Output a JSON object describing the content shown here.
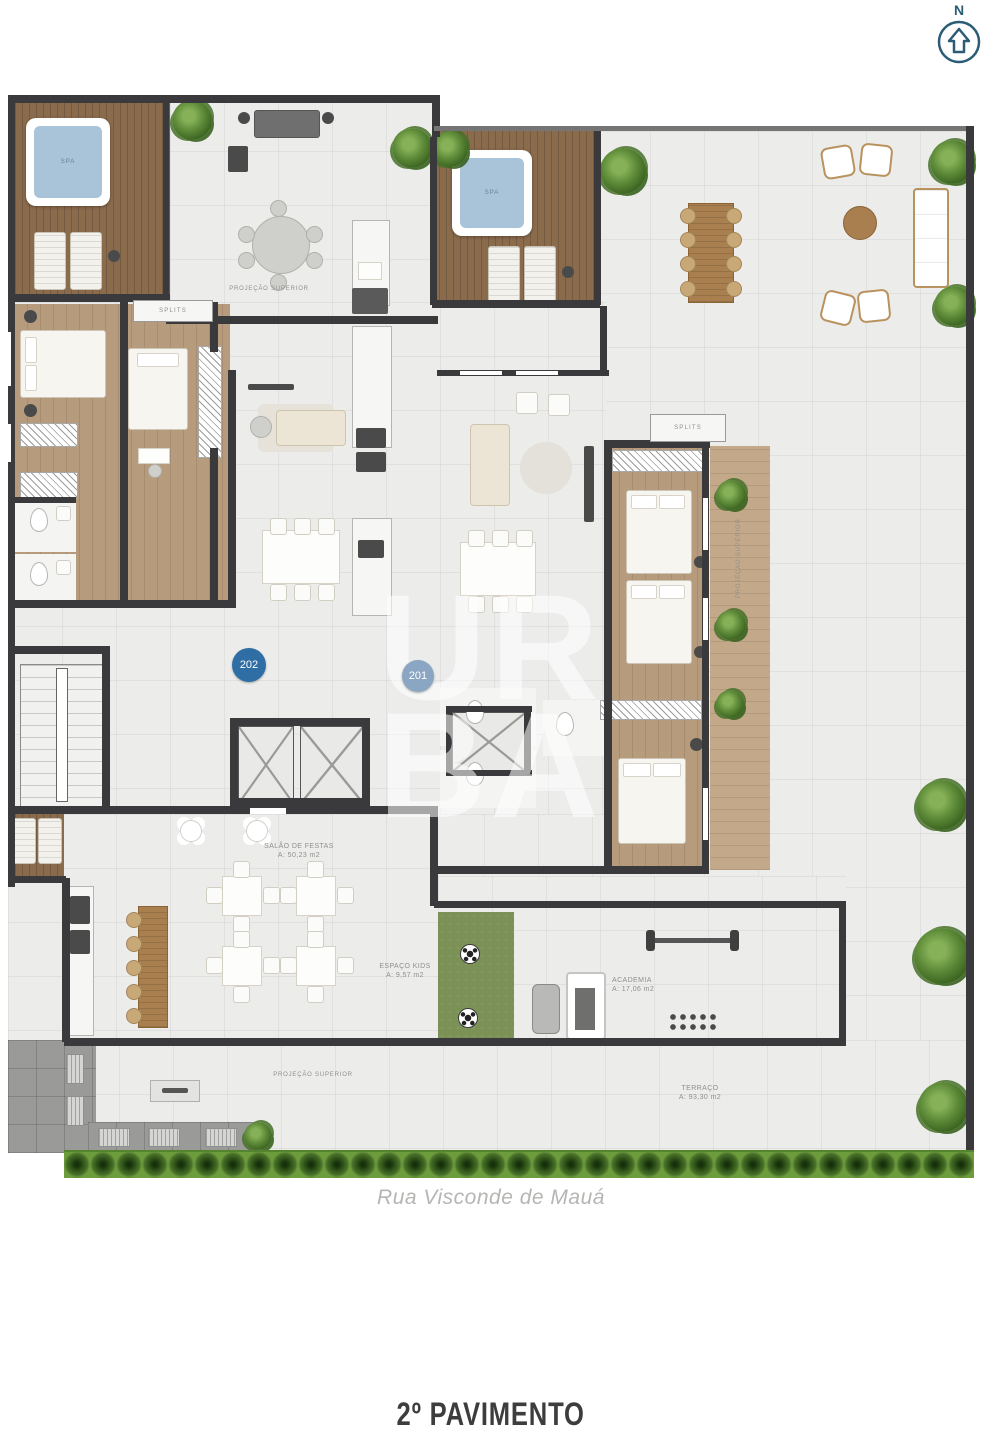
{
  "compass": {
    "letter": "N"
  },
  "plan": {
    "floor_title": "2º PAVIMENTO",
    "street_name": "Rua Visconde de Mauá",
    "watermark_line1": "UR",
    "watermark_line2": "BA",
    "unit_badges": [
      {
        "number": "202"
      },
      {
        "number": "201"
      }
    ],
    "rooms": {
      "spa_left": "SPA",
      "spa_right": "SPA",
      "splits_left": "SPLITS",
      "splits_right": "SPLITS",
      "projecao_top": "PROJEÇÃO SUPERIOR",
      "projecao_right": "PROJEÇÃO SUPERIOR",
      "projecao_bottom": "PROJEÇÃO SUPERIOR",
      "salao_name": "SALÃO DE FESTAS",
      "salao_area": "A: 50,23 m2",
      "kids_name": "ESPAÇO KIDS",
      "kids_area": "A: 9,57 m2",
      "academia_name": "ACADEMIA",
      "academia_area": "A: 17,06 m2",
      "terraco_name": "TERRAÇO",
      "terraco_area": "A: 93,30 m2"
    },
    "colors": {
      "wall": "#3a3a3c",
      "wood_deck": "#8a6b4c",
      "wood_floor": "#b79b7d",
      "tile": "#ecedeb",
      "turf_green": "#7b9156",
      "hedge_green": "#4e7a28",
      "spa_water": "#a9c4d8",
      "badge_202": "#2f6da5",
      "badge_201": "#8aa6c3",
      "compass_blue": "#2b5d77"
    }
  }
}
